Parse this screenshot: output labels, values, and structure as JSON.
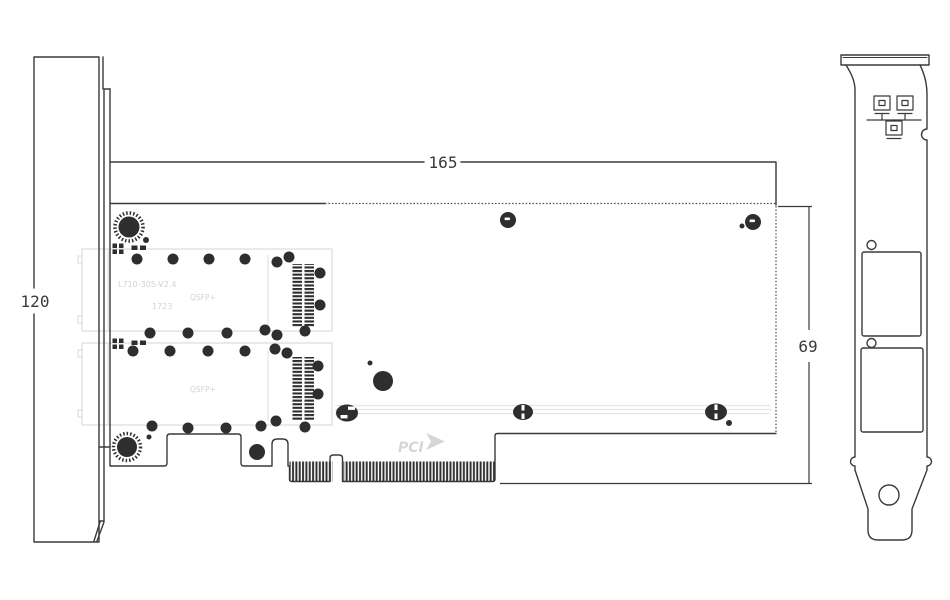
{
  "page": {
    "background": "#ffffff",
    "description_label": "mechanical drawing of dual-port PCIe network adapter card"
  },
  "colors": {
    "line": "#3a3a3a",
    "dark": "#2e2e2e",
    "hidden_line": "#555555",
    "faint": "#d8d8d8",
    "trace": "#e6e6e6",
    "background": "#ffffff"
  },
  "dimensions": {
    "card_length_mm": "165",
    "bracket_height_mm": "120",
    "card_height_mm": "69"
  },
  "silkscreen": {
    "model": "L710-305-V2.4",
    "date_code": "1723",
    "cage1_label": "QSFP+",
    "cage2_label": "QSFP+",
    "pcie_logo_text": "PCI"
  },
  "drawing": {
    "dots": [
      [
        137,
        259,
        5.5
      ],
      [
        173,
        259,
        5.5
      ],
      [
        209,
        259,
        5.5
      ],
      [
        245,
        259,
        5.5
      ],
      [
        277,
        262,
        5.5
      ],
      [
        289,
        257,
        5.5
      ],
      [
        320,
        273,
        5.5
      ],
      [
        320,
        305,
        5.5
      ],
      [
        150,
        333,
        5.5
      ],
      [
        188,
        333,
        5.5
      ],
      [
        227,
        333,
        5.5
      ],
      [
        265,
        330,
        5.5
      ],
      [
        277,
        335,
        5.5
      ],
      [
        305,
        331,
        5.5
      ],
      [
        133,
        351,
        5.5
      ],
      [
        170,
        351,
        5.5
      ],
      [
        208,
        351,
        5.5
      ],
      [
        245,
        351,
        5.5
      ],
      [
        275,
        349,
        5.5
      ],
      [
        287,
        353,
        5.5
      ],
      [
        318,
        366,
        5.5
      ],
      [
        318,
        394,
        5.5
      ],
      [
        152,
        426,
        5.5
      ],
      [
        188,
        428,
        5.5
      ],
      [
        226,
        428,
        5.5
      ],
      [
        261,
        426,
        5.5
      ],
      [
        276,
        421,
        5.5
      ],
      [
        305,
        427,
        5.5
      ],
      [
        383,
        381,
        10
      ],
      [
        257,
        452,
        8
      ],
      [
        508,
        220,
        8
      ],
      [
        753,
        222,
        8
      ],
      [
        146,
        240,
        3
      ],
      [
        149,
        437,
        2.5
      ],
      [
        370,
        363,
        2.5
      ],
      [
        742,
        226,
        2.5
      ],
      [
        729,
        423,
        3
      ]
    ],
    "pads": [
      [
        112.5,
        243.5,
        4.5,
        4.5
      ],
      [
        119,
        243.5,
        4.5,
        4.5
      ],
      [
        112.5,
        249.5,
        4.5,
        4.5
      ],
      [
        119,
        249.5,
        4.5,
        4.5
      ],
      [
        131.5,
        245.5,
        6,
        4.5
      ],
      [
        140,
        245.5,
        6,
        4.5
      ],
      [
        112.5,
        338.5,
        4.5,
        4.5
      ],
      [
        119,
        338.5,
        4.5,
        4.5
      ],
      [
        112.5,
        344.5,
        4.5,
        4.5
      ],
      [
        119,
        344.5,
        4.5,
        4.5
      ],
      [
        131.5,
        340.5,
        6,
        4.5
      ],
      [
        140,
        340.5,
        6,
        4.5
      ]
    ],
    "connector_columns": [
      [
        292.5,
        264,
        9.5,
        63
      ],
      [
        304.5,
        264,
        9.5,
        63
      ],
      [
        292.5,
        357,
        9.5,
        64
      ],
      [
        304.5,
        357,
        9.5,
        64
      ]
    ],
    "finger_strips": [
      [
        289.5,
        461.5,
        43,
        20
      ],
      [
        343.5,
        461.5,
        151,
        20
      ]
    ],
    "trace_lines": [
      [
        335,
        405.5,
        770,
        405.5
      ],
      [
        335,
        409.5,
        772,
        409.5
      ],
      [
        335,
        413.5,
        770,
        413.5
      ]
    ],
    "cage_tabs": [
      [
        78,
        256,
        4,
        7
      ],
      [
        78,
        316,
        4,
        7
      ],
      [
        78,
        350,
        4,
        7
      ],
      [
        78,
        410,
        4,
        7
      ]
    ]
  }
}
